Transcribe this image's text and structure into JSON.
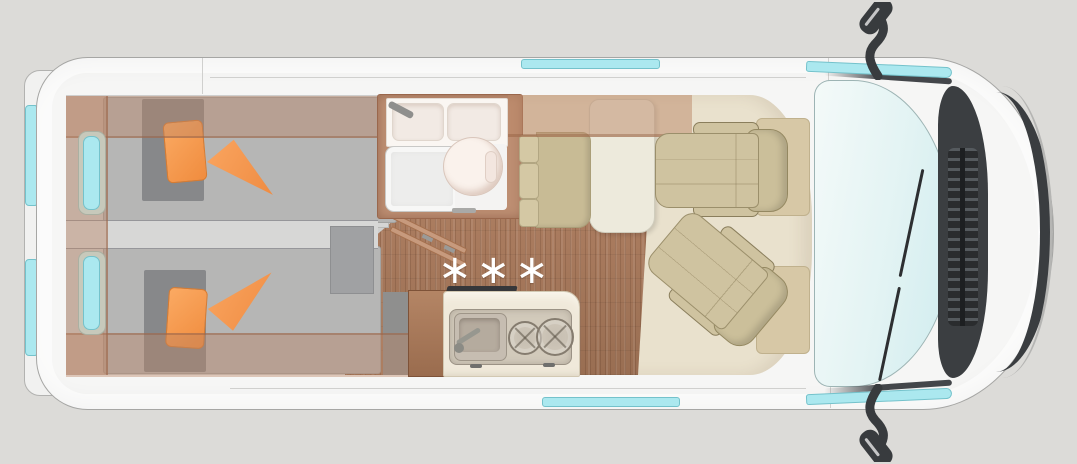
{
  "scene": {
    "type": "campervan-floorplan-top-view",
    "kitchen_marks": "∗∗∗"
  },
  "areas": [
    "rear-twin-beds",
    "bathroom",
    "kitchen",
    "dinette",
    "swivel-seats",
    "driver-cab"
  ],
  "colors": {
    "bg": "#dcdbd8",
    "body": "#f6f6f5",
    "outline": "#a6a6a4",
    "window-teal": "#abe8ef",
    "window-border": "#74c2cb",
    "beige-floor": "#e9e1cd",
    "room-gray": "#cfcfce",
    "wood": "#a87a5e",
    "cabinet-wood": "#bd8e72",
    "mattress": "#b6b6b5",
    "blanket": "#87888a",
    "orange": "#f89c57",
    "seat-tan": "#cfc3a0",
    "table-cream": "#edeadc",
    "counter": "#f0e9da",
    "shower": "#ededec",
    "dark-trim": "#3b3e41",
    "windshield-a": "#f4faf9",
    "windshield-b": "#cfecef"
  }
}
